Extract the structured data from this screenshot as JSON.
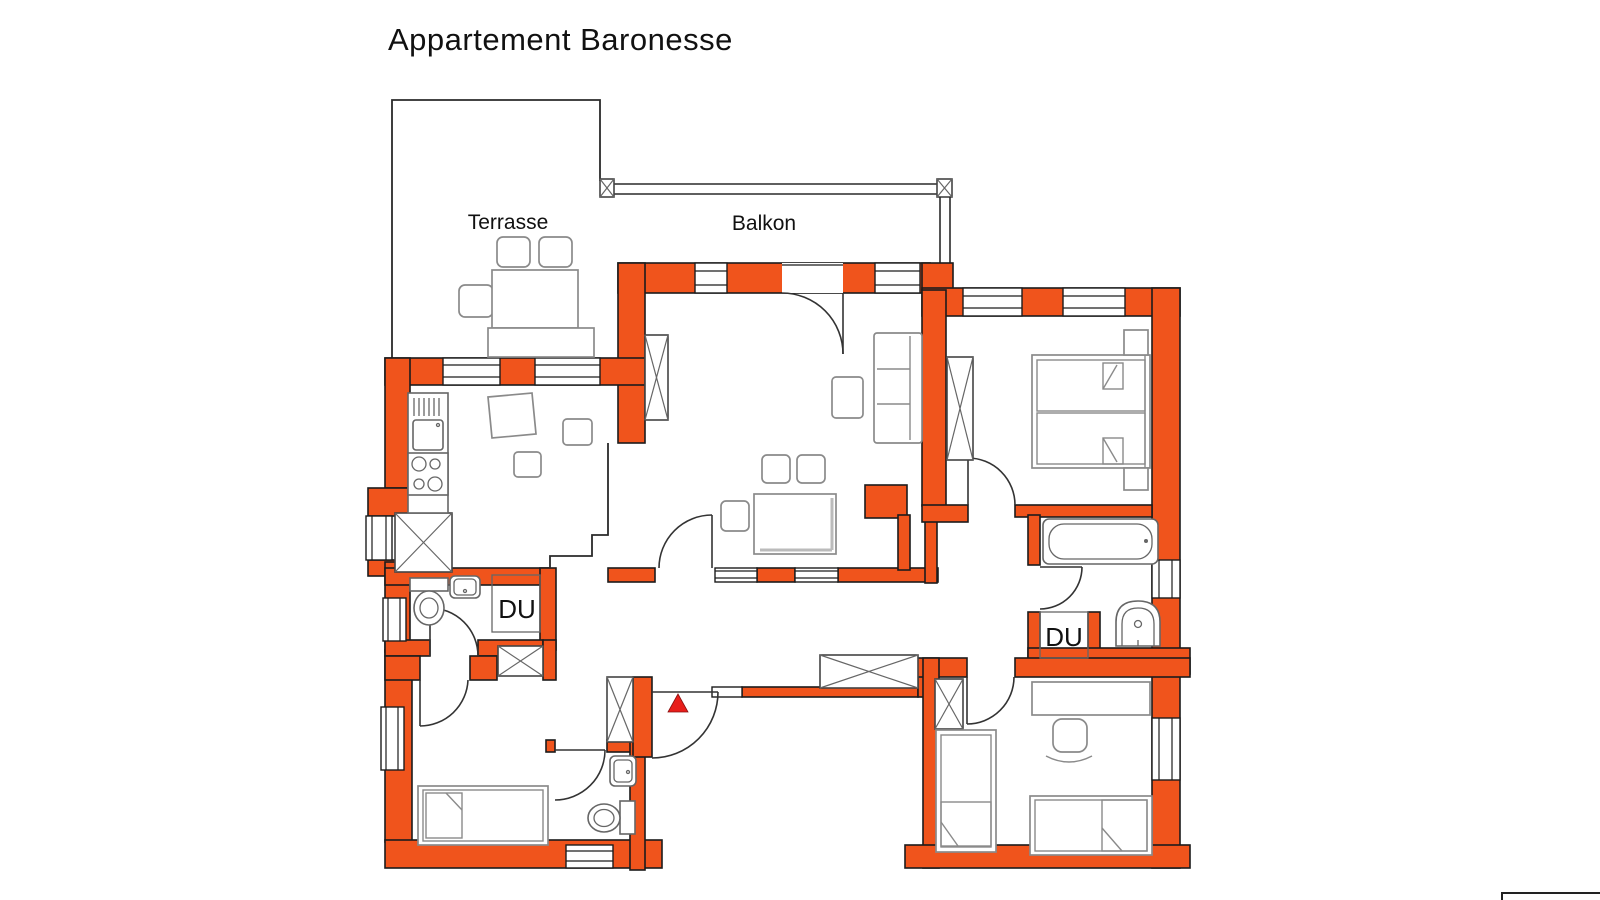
{
  "page": {
    "title": "Appartement Baronesse"
  },
  "plan": {
    "labels": {
      "terrace": "Terrasse",
      "balcony": "Balkon",
      "shower_left": "DU",
      "shower_right": "DU"
    },
    "colors": {
      "wall": "#F0541C",
      "entrance_marker": "#E81E1A",
      "furniture_line": "#8a8a8a",
      "outline": "#1c1c1c"
    }
  }
}
